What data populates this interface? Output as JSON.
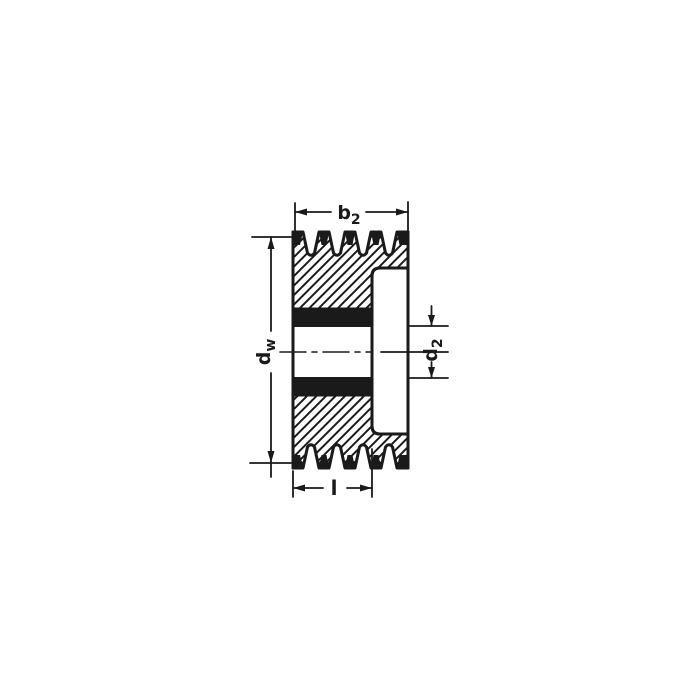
{
  "drawing": {
    "ink_color": "#1a1a1a",
    "background_color": "#ffffff",
    "labels": {
      "width": {
        "base": "b",
        "sub": "2"
      },
      "pitch_diameter": {
        "base": "d",
        "sub": "w"
      },
      "bore_diameter": {
        "base": "d",
        "sub": "2"
      },
      "hub_length": {
        "base": "l",
        "sub": ""
      }
    }
  }
}
